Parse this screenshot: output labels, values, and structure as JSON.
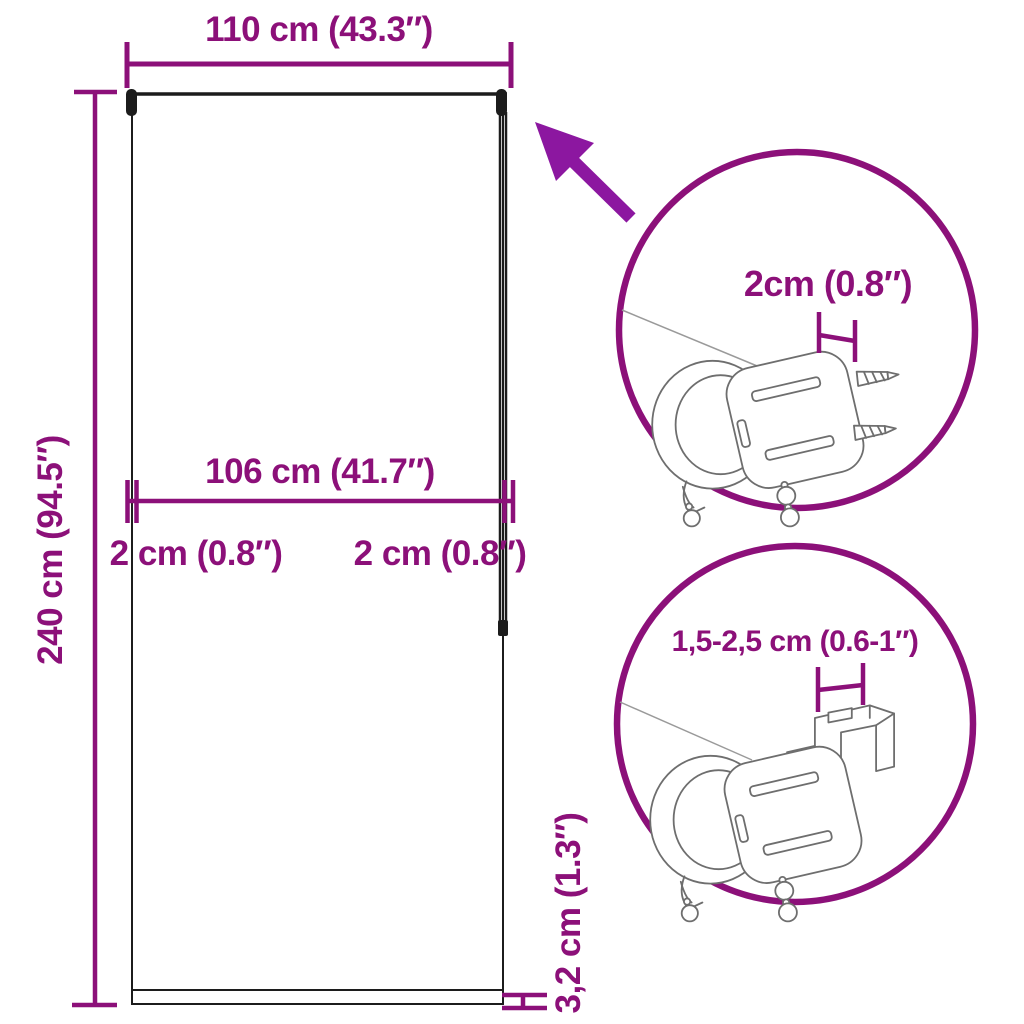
{
  "diagram": {
    "type": "product-dimension-diagram",
    "subject": "roller blind with mounting bracket details"
  },
  "colors": {
    "dimension": "#8C1079",
    "arrow": "#8C17A0",
    "outline": "#1C1C1C",
    "art": "#6E6E6E",
    "background": "#FFFFFF"
  },
  "dimensions": {
    "width": {
      "label": "110 cm (43.3″)"
    },
    "height": {
      "label": "240 cm (94.5″)"
    },
    "fabric_width": {
      "label": "106 cm (41.7″)"
    },
    "side_gap_left": {
      "label": "2 cm (0.8″)"
    },
    "side_gap_right": {
      "label": "2 cm (0.8″)"
    },
    "bottom_bar": {
      "label": "3,2 cm (1.3″)"
    }
  },
  "details": {
    "top": {
      "label": "2cm (0.8″)"
    },
    "bottom": {
      "label": "1,5-2,5 cm (0.6-1″)"
    }
  }
}
